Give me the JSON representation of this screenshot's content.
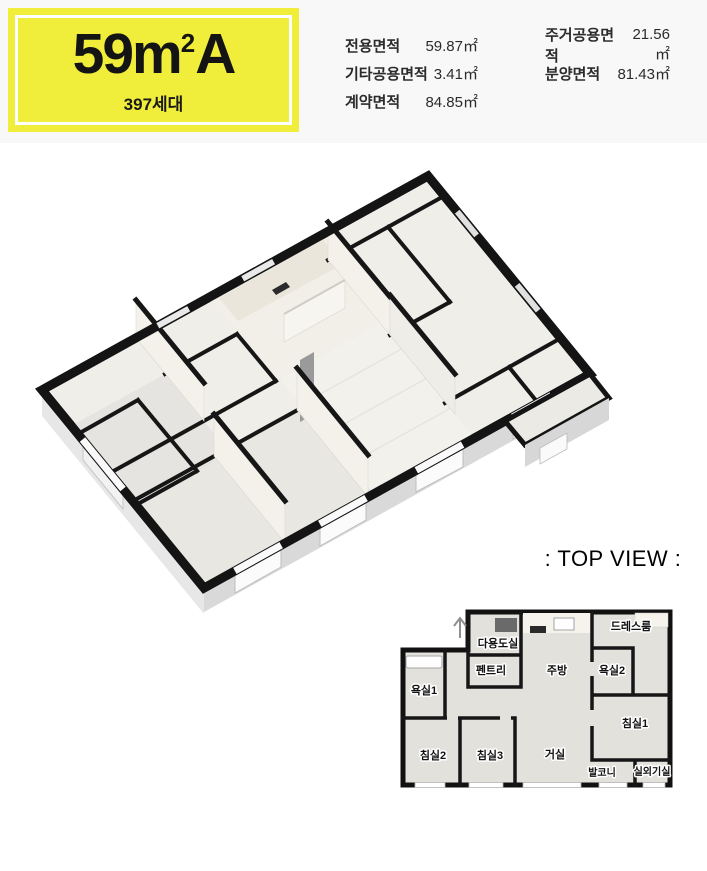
{
  "colors": {
    "badge_yellow": "#f0ee3b",
    "header_background": "#f8f8f8",
    "wall_black": "#161616"
  },
  "badge": {
    "title_main": "59m",
    "title_sup": "2",
    "title_tail": "A",
    "households": "397세대"
  },
  "area_table": {
    "columns": [
      {
        "rows": [
          {
            "label": "전용면적",
            "value": "59.87㎡"
          },
          {
            "label": "기타공용면적",
            "value": "3.41㎡"
          },
          {
            "label": "계약면적",
            "value": "84.85㎡"
          }
        ]
      },
      {
        "rows": [
          {
            "label": "주거공용면적",
            "value": "21.56㎡"
          },
          {
            "label": "분양면적",
            "value": "81.43㎡"
          }
        ]
      }
    ]
  },
  "top_view": {
    "caption": ": TOP VIEW :",
    "rooms": [
      {
        "name": "다용도실"
      },
      {
        "name": "드레스룸"
      },
      {
        "name": "펜트리"
      },
      {
        "name": "주방"
      },
      {
        "name": "욕실2"
      },
      {
        "name": "욕실1"
      },
      {
        "name": "침실1"
      },
      {
        "name": "침실2"
      },
      {
        "name": "침실3"
      },
      {
        "name": "거실"
      },
      {
        "name": "발코니"
      },
      {
        "name": "실외기실"
      }
    ]
  }
}
